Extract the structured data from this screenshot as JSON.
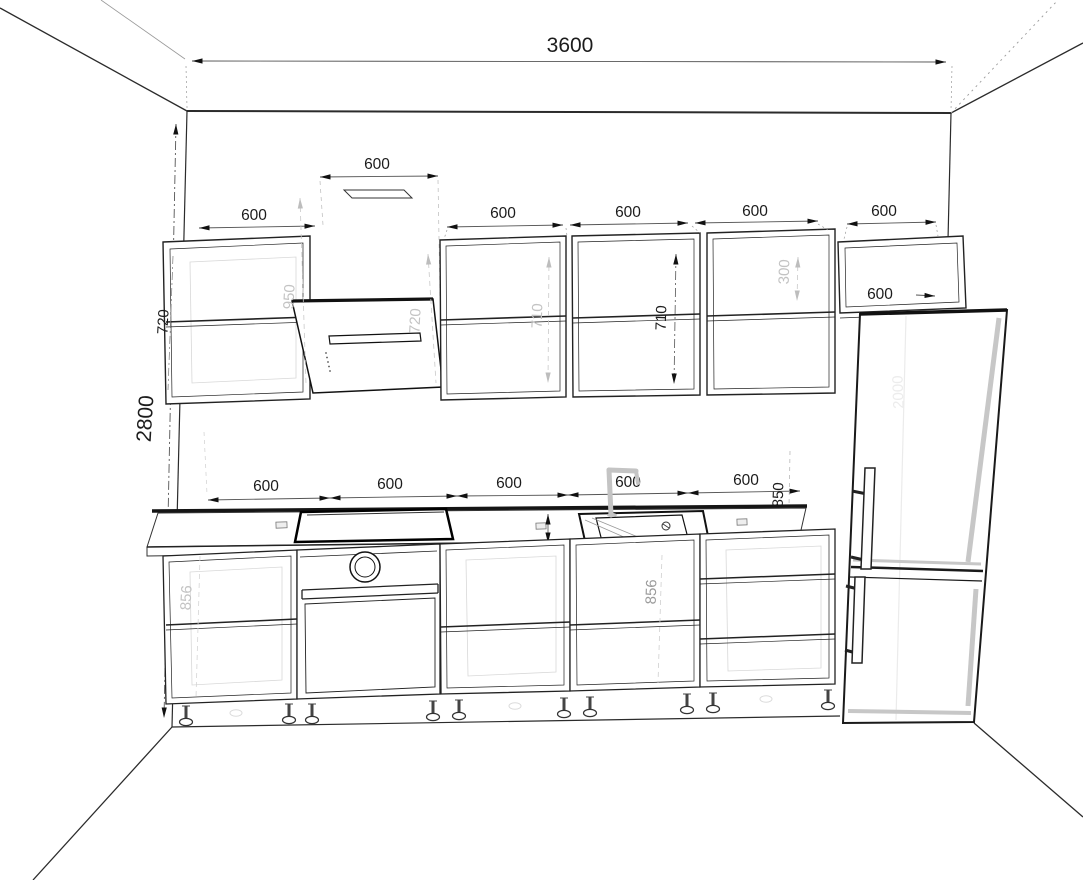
{
  "drawing": {
    "room": {
      "wall_width": "3600",
      "wall_height": "2800"
    },
    "upper_row": {
      "left_cabinet_width": "600",
      "left_cabinet_height": "720",
      "hood_width": "600",
      "hood_height": "720",
      "hood_clearance": "950",
      "cabinet_a_width": "600",
      "cabinet_b_width": "600",
      "cabinet_c_width": "600",
      "cabinet_a_height": "710",
      "cabinet_b_height": "710",
      "fridge_cabinet_width": "600",
      "fridge_cabinet_height": "300",
      "fridge_cabinet_depth": "600"
    },
    "base_row": {
      "cabinet_1_width": "600",
      "cabinet_2_width": "600",
      "cabinet_3_width": "600",
      "cabinet_4_width": "600",
      "cabinet_5_width": "600",
      "worktop_height": "850",
      "cabinet_1_height": "856",
      "sink_cabinet_height": "856"
    },
    "fridge": {
      "height": "2000"
    }
  }
}
